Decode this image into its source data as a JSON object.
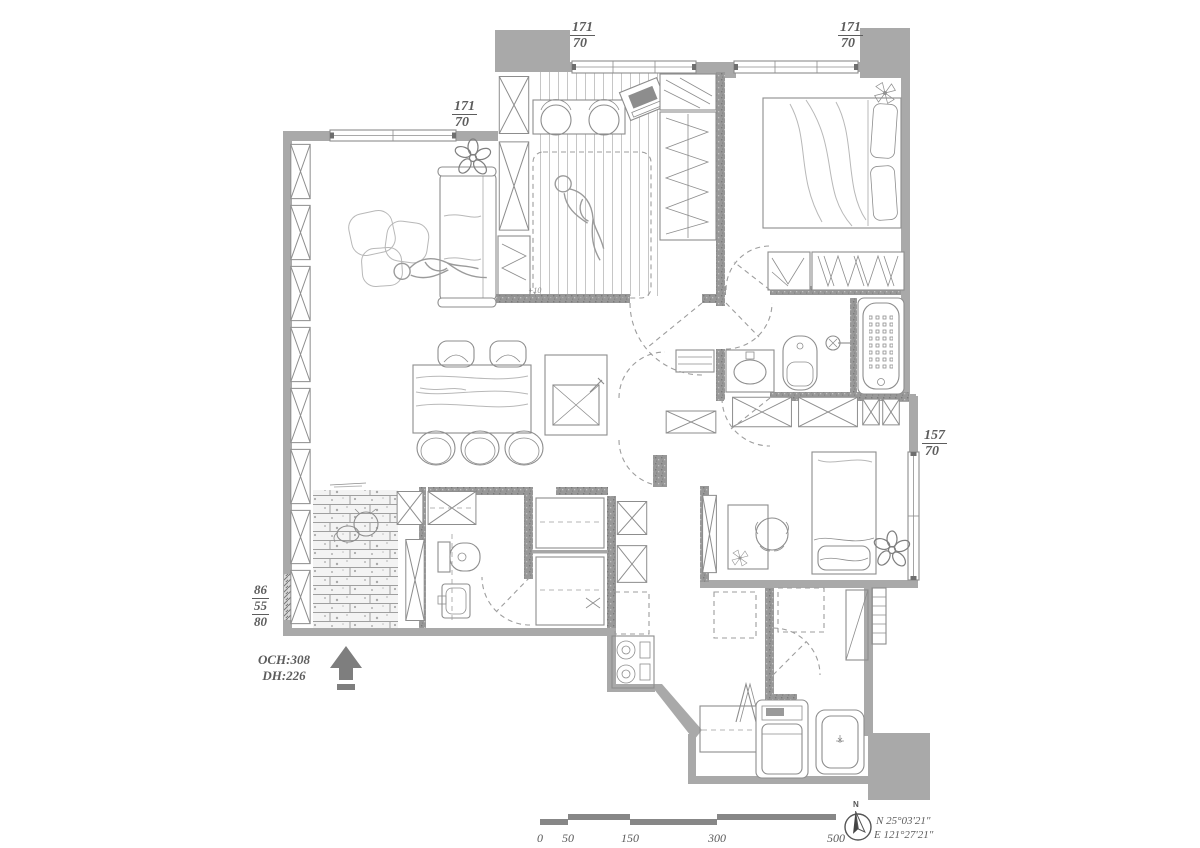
{
  "document_type": "apartment floor plan drawing",
  "colors": {
    "background": "#ffffff",
    "exterior_wall": "#a9a9a9",
    "interior_partition": "#929292",
    "drawing_line": "#8d8d8d",
    "annotation_text": "#5d5d5d",
    "entry_arrow": "#7e7e7e"
  },
  "dimension_labels": {
    "window_top_left": {
      "numerator": "171",
      "denominator": "70"
    },
    "window_top_right": {
      "numerator": "171",
      "denominator": "70"
    },
    "window_living": {
      "numerator": "171",
      "denominator": "70"
    },
    "window_bedroom2": {
      "numerator": "157",
      "denominator": "70"
    },
    "left_wall_stack": [
      "86",
      "55",
      "80"
    ],
    "ceiling_height": "OCH:308",
    "door_height": "DH:226",
    "floor_level_note": "+10"
  },
  "scale_bar": {
    "tick_labels": [
      "0",
      "50",
      "150",
      "300",
      "500"
    ]
  },
  "compass": {
    "north_letter": "N",
    "latitude": "N 25°03'21\"",
    "longitude": "E 121°27'21\""
  },
  "symbols": [
    "sofa-icon",
    "bean-bag-icon",
    "plant-icon",
    "person-icon",
    "dining-table-icon",
    "chair-icon",
    "island-sink-icon",
    "desk-icon",
    "laptop-icon",
    "mattress-icon",
    "double-bed-icon",
    "single-bed-icon",
    "wardrobe-hangers-icon",
    "x-cabinet-icon",
    "toilet-icon",
    "washbasin-icon",
    "bathtub-icon",
    "shower-icon",
    "stove-icon",
    "washing-machine-icon",
    "laundry-sink-icon",
    "drying-rack-icon",
    "dog-icon",
    "ceiling-fan-icon",
    "door-swing-icon",
    "window-icon",
    "entry-arrow-icon",
    "scale-bar-icon",
    "compass-rose-icon"
  ]
}
